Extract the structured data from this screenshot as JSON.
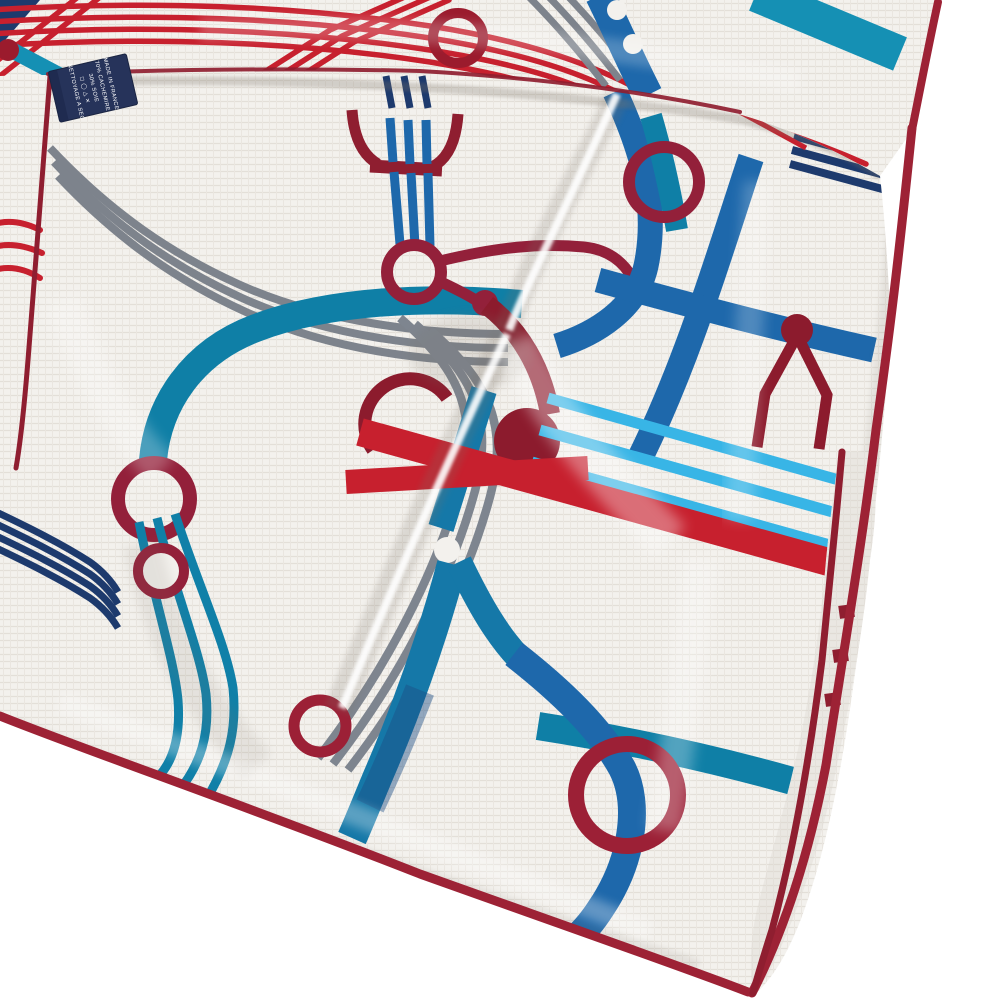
{
  "page": {
    "title": "Folded scarf product photo",
    "background_color": "#ffffff"
  },
  "scarf": {
    "description": "Off-white linen-textured square scarf, folded in overlapping layers on a white background, printed with a suspender-strap pattern: groups of parallel ribbon stripes, wide solid straps, rivet rings and strap junctions, finished with a burgundy hand-rolled hem",
    "fabric_color": "#f3f1ed",
    "hem_color": "#8f1e30",
    "palette": {
      "crimson_red": "#c7202e",
      "burgundy_hem": "#8f1e30",
      "maroon_ring": "#93203a",
      "steel_blue": "#1e68ab",
      "petrol_blue": "#1578a8",
      "teal": "#0f7fa6",
      "sky_blue": "#38b5e6",
      "navy": "#1d3a6d",
      "gray": "#7d838c",
      "fabric": "#f3f1ed"
    },
    "motifs": [
      "parallel-ribbon-stripes",
      "solid-straps",
      "rivet-rings",
      "strap-junctions",
      "trumpet-flare",
      "rolled-hem-dashes"
    ]
  },
  "care_label": {
    "background": "#26335a",
    "text_color": "#ffffff",
    "lines": [
      "MADE IN FRANCE",
      "70% CACHEMIRE",
      "30% SOIE",
      "◻ ◯ △ ✕",
      "NETTOYAGE A SEC"
    ]
  }
}
